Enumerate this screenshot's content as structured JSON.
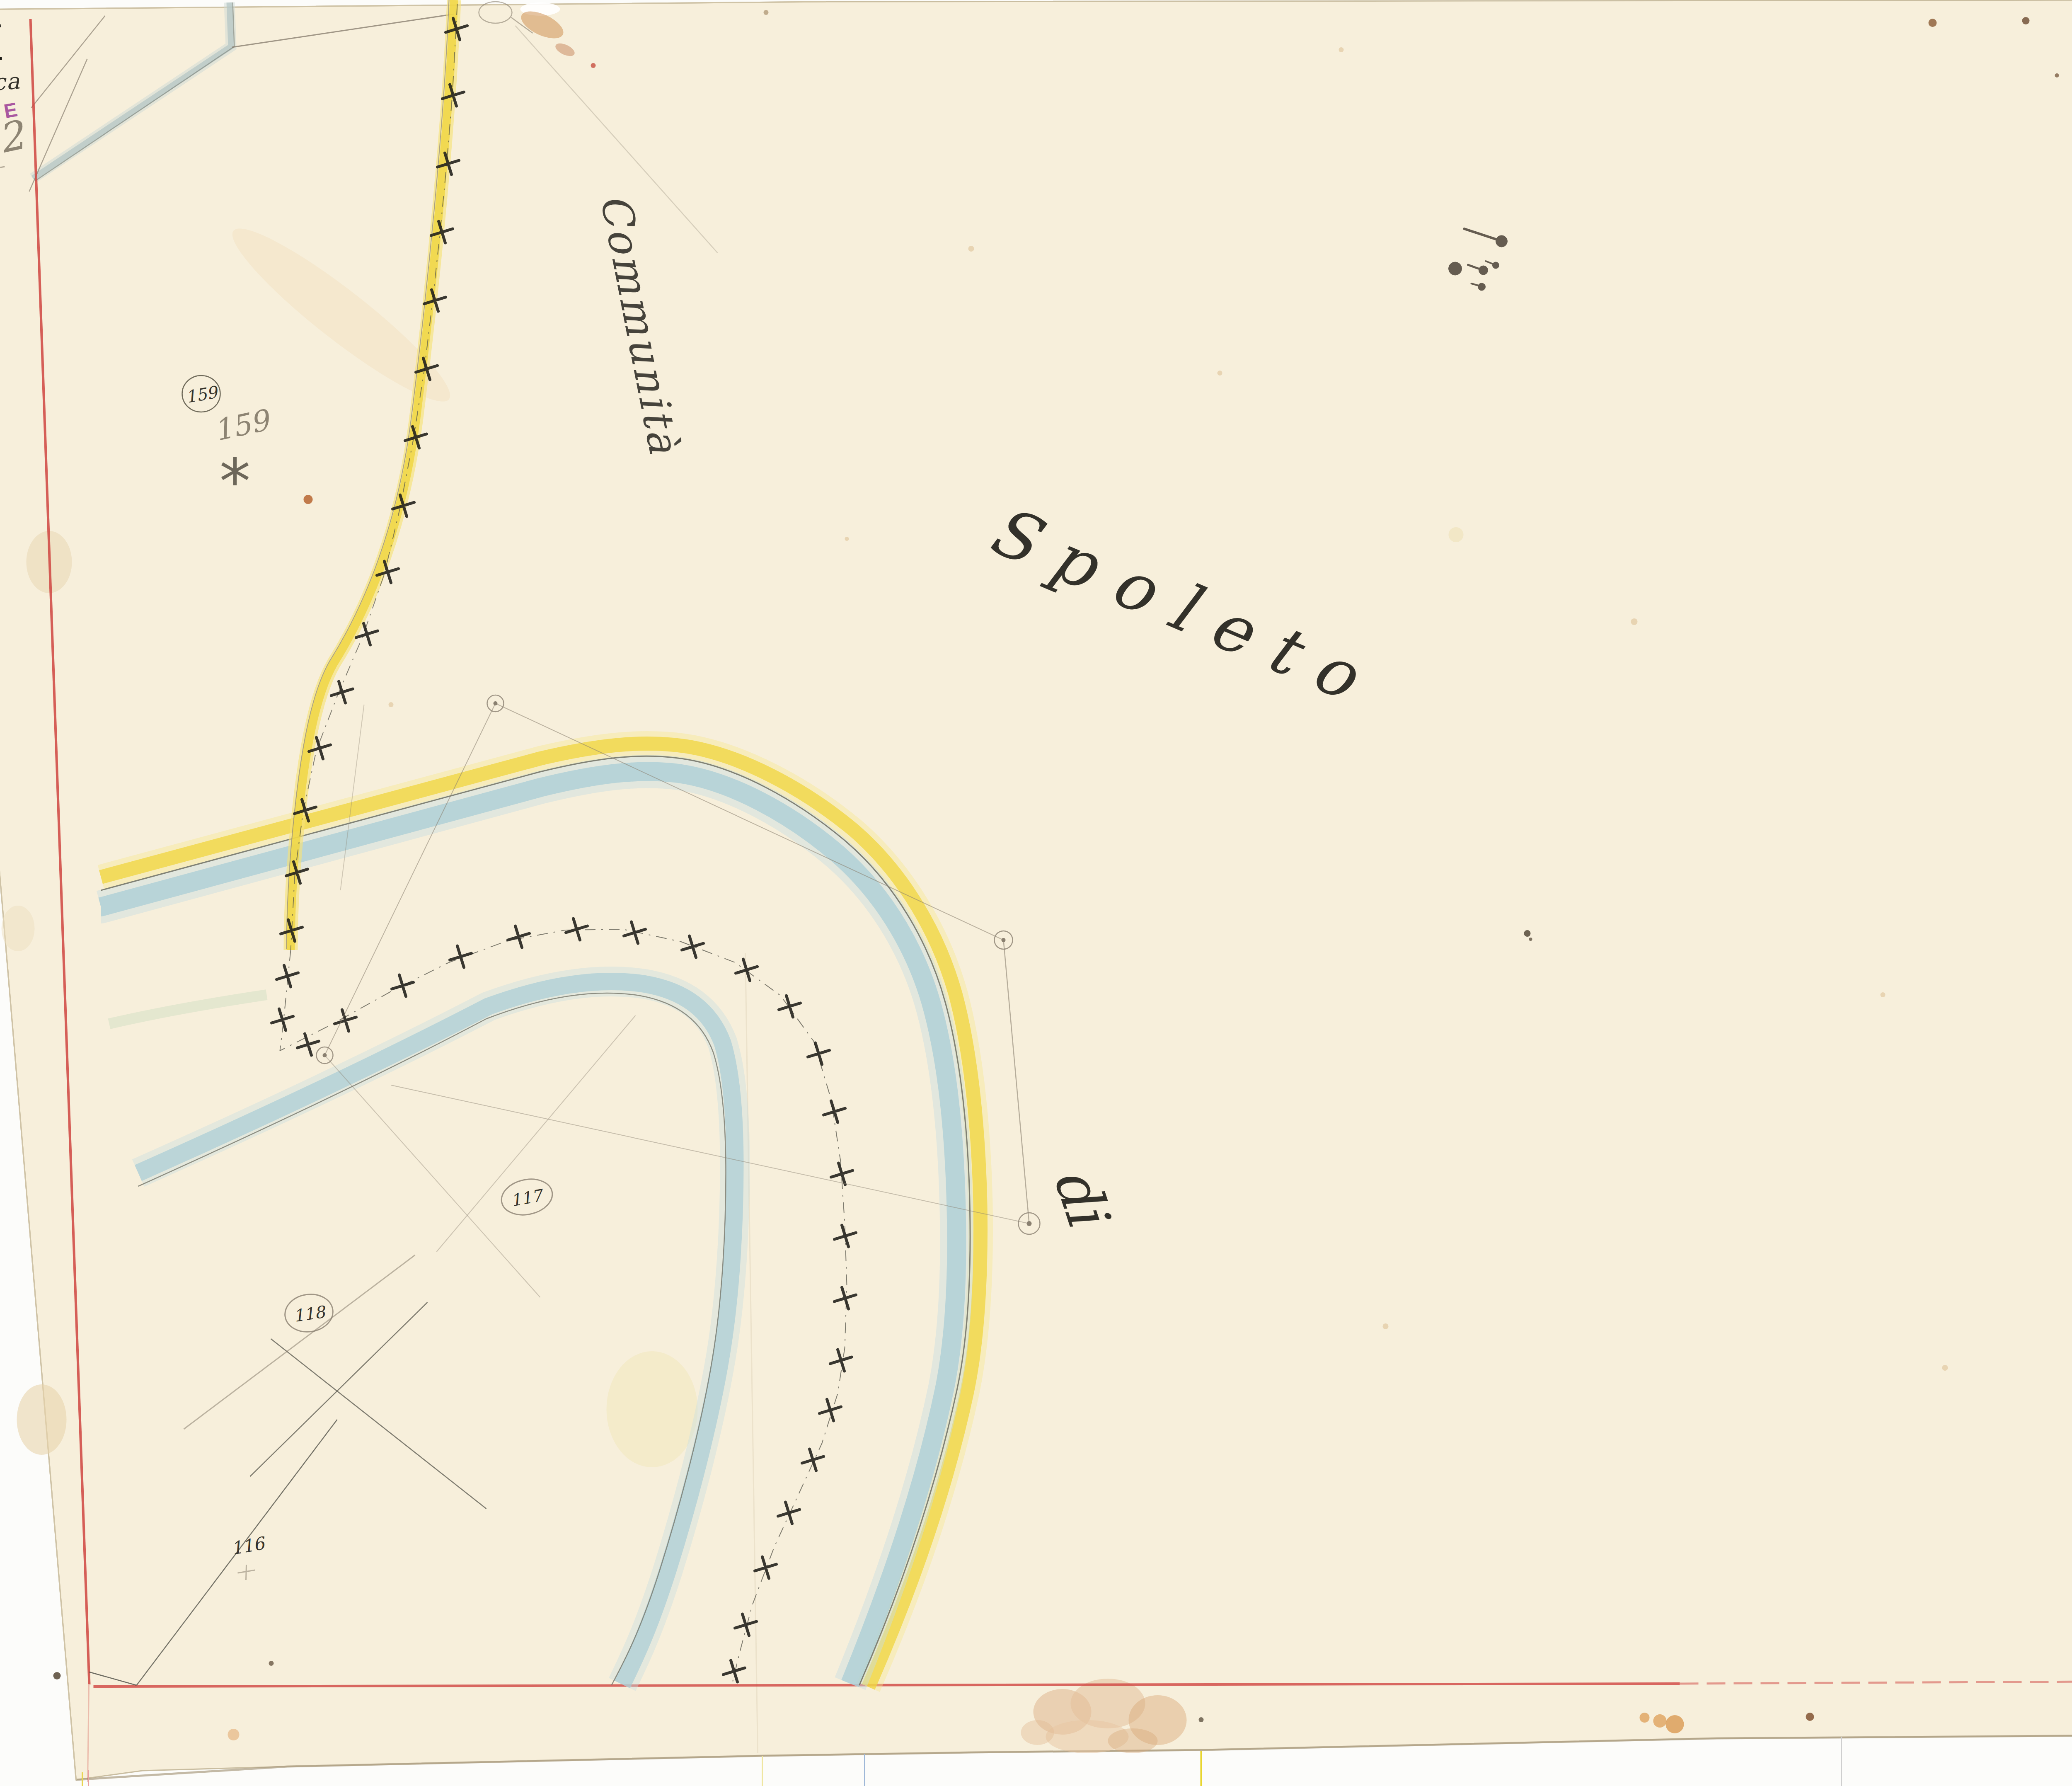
{
  "sheet": {
    "corner_number_red": "7",
    "section_number": "XI",
    "map_number_red": "15",
    "section_name": "Baucca",
    "stamp_label": "ORTE",
    "pencil_note": "fog 2",
    "neighbor_label_word1": "Communit\u00e0",
    "neighbor_label_word2": "di",
    "neighbor_label_word3": "Spoleto"
  },
  "parcels": {
    "p159_circled": "159",
    "p159_pencil": "159",
    "p159_star": "*",
    "p117": "117",
    "p118": "118",
    "p116": "116"
  },
  "colors": {
    "paper": "#f7efdb",
    "frame_red": "#cf4440",
    "road_yellow": "#f0d63e",
    "water_blue": "#a9cdd5",
    "stamp_purple": "#9c3d96",
    "ink": "#33312a",
    "pencil": "#8a8070",
    "red_numbers": "#c23a30"
  }
}
